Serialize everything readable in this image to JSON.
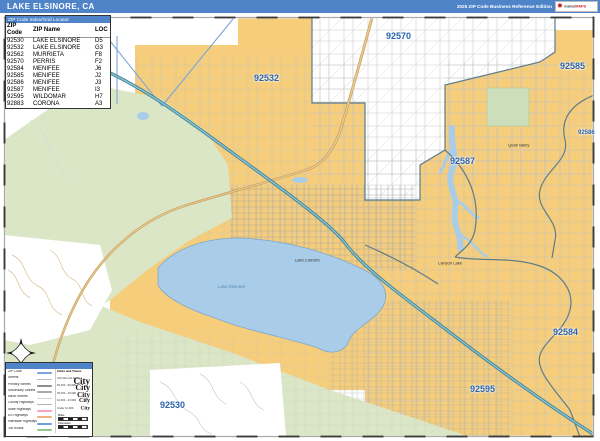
{
  "header": {
    "title": "LAKE ELSINORE, CA",
    "edition": "2025 ZIP Code Business Reference Edition",
    "logo": {
      "brand_prefix": "market",
      "brand_suffix": "MAPS"
    }
  },
  "zip_table": {
    "title": "ZIP Code Index/Grid Locator",
    "columns": [
      "ZIP Code",
      "ZIP Name",
      "LOC"
    ],
    "rows": [
      {
        "zip": "92530",
        "name": "LAKE ELSINORE",
        "loc": "D5"
      },
      {
        "zip": "92532",
        "name": "LAKE ELSINORE",
        "loc": "G3"
      },
      {
        "zip": "92562",
        "name": "MURRIETA",
        "loc": "F8"
      },
      {
        "zip": "92570",
        "name": "PERRIS",
        "loc": "F2"
      },
      {
        "zip": "92584",
        "name": "MENIFEE",
        "loc": "J6"
      },
      {
        "zip": "92585",
        "name": "MENIFEE",
        "loc": "J2"
      },
      {
        "zip": "92586",
        "name": "MENIFEE",
        "loc": "J3"
      },
      {
        "zip": "92587",
        "name": "MENIFEE",
        "loc": "I3"
      },
      {
        "zip": "92595",
        "name": "WILDOMAR",
        "loc": "H7"
      },
      {
        "zip": "92883",
        "name": "CORONA",
        "loc": "A3"
      }
    ]
  },
  "map": {
    "zip_labels": {
      "z92570": "92570",
      "z92532": "92532",
      "z92585": "92585",
      "z92586": "92586",
      "z92587": "92587",
      "z92584": "92584",
      "z92595": "92595",
      "z92530": "92530"
    },
    "city_labels": {
      "lake_elsinore": "Lake Elsinore",
      "quail_valley": "Quail Valley",
      "canyon_lake": "Canyon Lake"
    },
    "water_labels": {
      "lake_elsinore": "Lake Elsinore"
    }
  },
  "legend": {
    "title": "Lake Elsinore, CA ZIP Code Map",
    "items": [
      {
        "label": "ZIP Code"
      },
      {
        "label": "Streets"
      },
      {
        "label": "Primary Streets"
      },
      {
        "label": "Secondary Streets"
      },
      {
        "label": "Minor Streets"
      },
      {
        "label": "County Highways"
      },
      {
        "label": "State Highways"
      },
      {
        "label": "US Highways"
      },
      {
        "label": "Interstate Highways"
      },
      {
        "label": "Toll Roads"
      }
    ],
    "cities_header": "Cities and Towns",
    "city_classes": [
      {
        "range": "100,000 and Above",
        "sample": "City"
      },
      {
        "range": "50,000 - 99,999",
        "sample": "City"
      },
      {
        "range": "25,000 - 49,999",
        "sample": "City"
      },
      {
        "range": "10,000 - 24,999",
        "sample": "City"
      },
      {
        "range": "Under 10,000",
        "sample": "City"
      }
    ],
    "scale": {
      "miles": "Miles",
      "kilometers": "Kilometers"
    }
  },
  "colors": {
    "banner_blue": "#4f85c8",
    "zip_area_yellow": "#f6ce7b",
    "terrain_green": "#dbe6c6",
    "water_blue": "#a9cde8",
    "zip_label_blue": "#2b63ae",
    "boundary_slate": "#5e7c8c",
    "interstate_blue": "#44808e",
    "state_route_tan": "#ddb97e"
  }
}
